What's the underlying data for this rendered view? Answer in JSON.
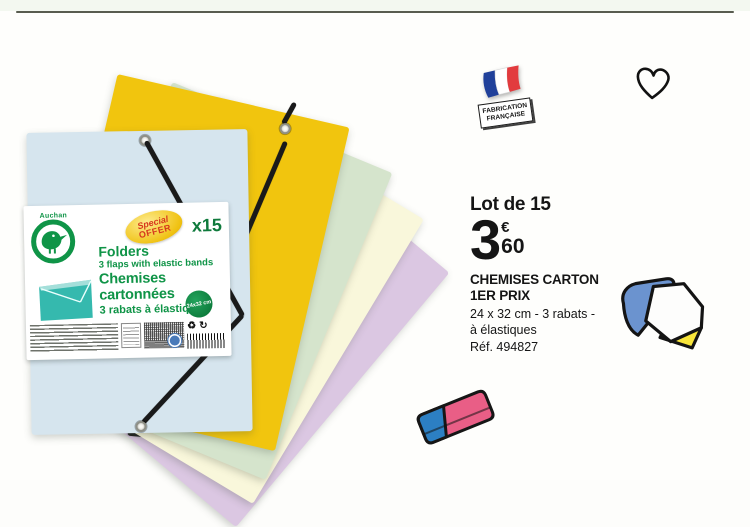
{
  "ad": {
    "brand": "Auchan",
    "label": {
      "special_line1": "Special",
      "special_line2": "OFFER",
      "multiplier": "x15",
      "title_en": "Folders",
      "sub_en": "3 flaps with elastic bands",
      "title_fr": "Chemises cartonnées",
      "sub_fr": "3 rabats à élastiques",
      "size_badge": "24x32 cm"
    },
    "made_in": {
      "line1": "FABRICATION",
      "line2": "FRANÇAISE"
    },
    "offer": {
      "lot": "Lot de 15",
      "price_int": "3",
      "price_currency": "€",
      "price_cents": "60",
      "name_line1": "CHEMISES CARTON",
      "name_line2": "1ER PRIX",
      "desc_line1": "24 x 32 cm - 3 rabats -",
      "desc_line2": "à élastiques",
      "ref": "Réf. 494827"
    }
  },
  "folders": [
    {
      "name": "lavender",
      "color": "#dbc7e2"
    },
    {
      "name": "cream",
      "color": "#f9f7db"
    },
    {
      "name": "mint-green",
      "color": "#d5e4cc"
    },
    {
      "name": "yellow",
      "color": "#f1c50e"
    },
    {
      "name": "light-blue",
      "color": "#d6e5ee"
    }
  ],
  "icons": {
    "recycle": "♻",
    "reuse": "↻"
  },
  "colors": {
    "auchan_green": "#0f9447",
    "offer_red": "#d6381c",
    "flag_blue": "#20409a",
    "flag_red": "#e23b3e",
    "eraser_pink": "#e95e86",
    "eraser_blue": "#2c7fc3",
    "illustration_blue": "#6b93cf",
    "illustration_yellow": "#f8e53a",
    "price_text": "#151515",
    "top_rule": "#585c4f"
  }
}
